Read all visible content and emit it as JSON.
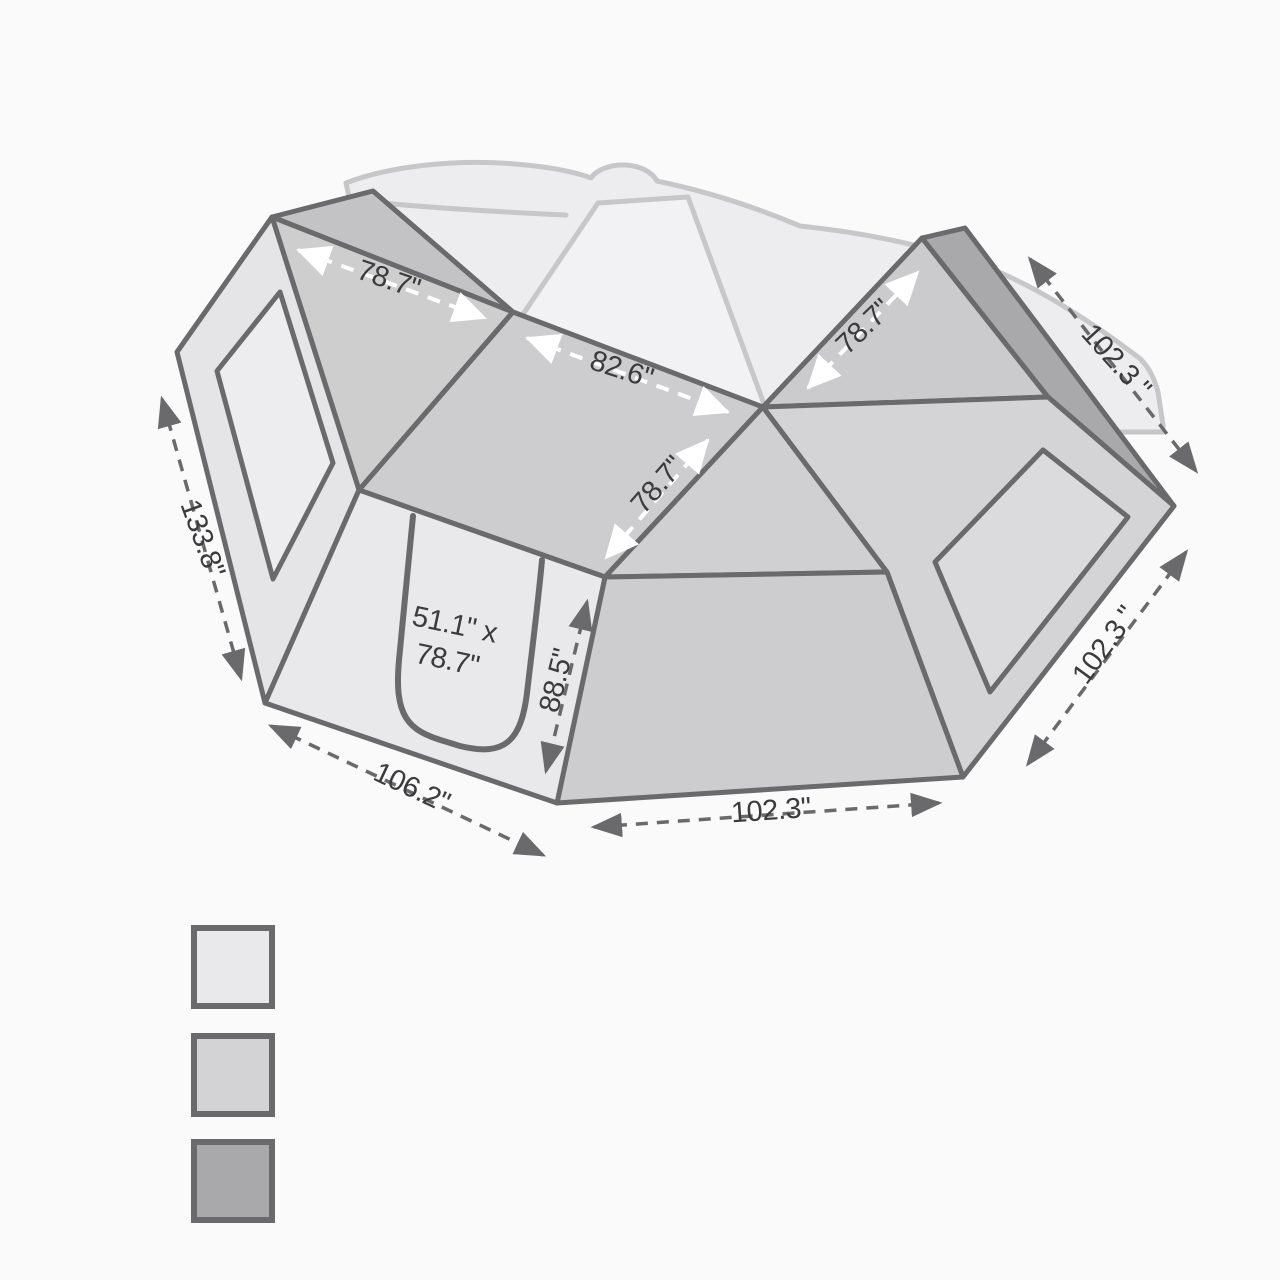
{
  "diagram": {
    "dimensions": {
      "roof_left_width": "78.7\"",
      "roof_center_width": "82.6\"",
      "roof_center_depth": "78.7\"",
      "roof_right_width": "78.7\"",
      "rail_length_top": "102.3 \"",
      "wall_right_width": "102.3 \"",
      "front_right_width": "102.3\"",
      "front_left_width": "106.2\"",
      "side_left_length": "133.8\"",
      "wall_height": "88.5\"",
      "door_size_line1": "51.1\" x",
      "door_size_line2": "78.7\""
    }
  },
  "legend": {
    "swatches": [
      {
        "name": "light-fabric-swatch",
        "color": "#e9e9eb"
      },
      {
        "name": "medium-fabric-swatch",
        "color": "#d3d3d5"
      },
      {
        "name": "dark-rail-swatch",
        "color": "#a9a9ab"
      }
    ]
  },
  "colors": {
    "background": "#fafafb",
    "outline": "#6a6a6c",
    "ghost_fill": "#ededef",
    "glass_fill": "#f2f2f4",
    "roof_back_triangle": "#c3c3c5",
    "roof_left": "#cecece",
    "roof_center": "#cdcdcf",
    "roof_lower_right": "#d0d0d2",
    "roof_right": "#cbcbcd",
    "rail_strip": "#a9a9ab",
    "wall_right": "#d4d4d6",
    "window_right": "#dbdbdd",
    "front_right": "#cdcdcf",
    "wall_left": "#e5e5e7",
    "window_left": "#ededef",
    "door_panel": "#e9e9eb"
  }
}
